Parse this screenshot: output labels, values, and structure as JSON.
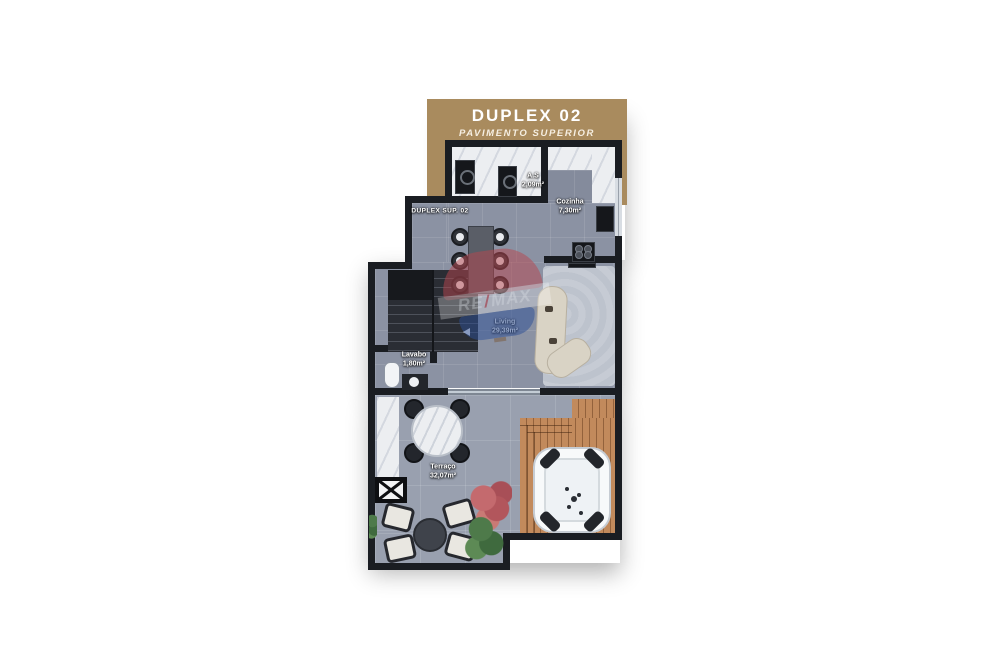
{
  "banner": {
    "title": "DUPLEX 02",
    "subtitle": "PAVIMENTO SUPERIOR",
    "bg_color": "#a98b5e"
  },
  "unit_label": "DUPLEX SUP. 02",
  "rooms": {
    "service": {
      "name": "A.S",
      "area": "2,09m²"
    },
    "kitchen": {
      "name": "Cozinha",
      "area": "7,30m²"
    },
    "living": {
      "name": "Living",
      "area": "29,39m²"
    },
    "lavatory": {
      "name": "Lavabo",
      "area": "1,80m²"
    },
    "terrace": {
      "name": "Terraço",
      "area": "32,07m²"
    }
  },
  "watermark": {
    "brand_left": "RE",
    "brand_slash": "/",
    "brand_right": "MAX",
    "balloon_red": "#b8464e",
    "balloon_blue": "#2d4f96"
  },
  "colors": {
    "wall": "#1a1d22",
    "floor_interior": "#8b92a3",
    "floor_terrace": "#99a0af",
    "deck_wood": "#c28a5c",
    "marble": "#eceef1",
    "background": "#ffffff"
  }
}
